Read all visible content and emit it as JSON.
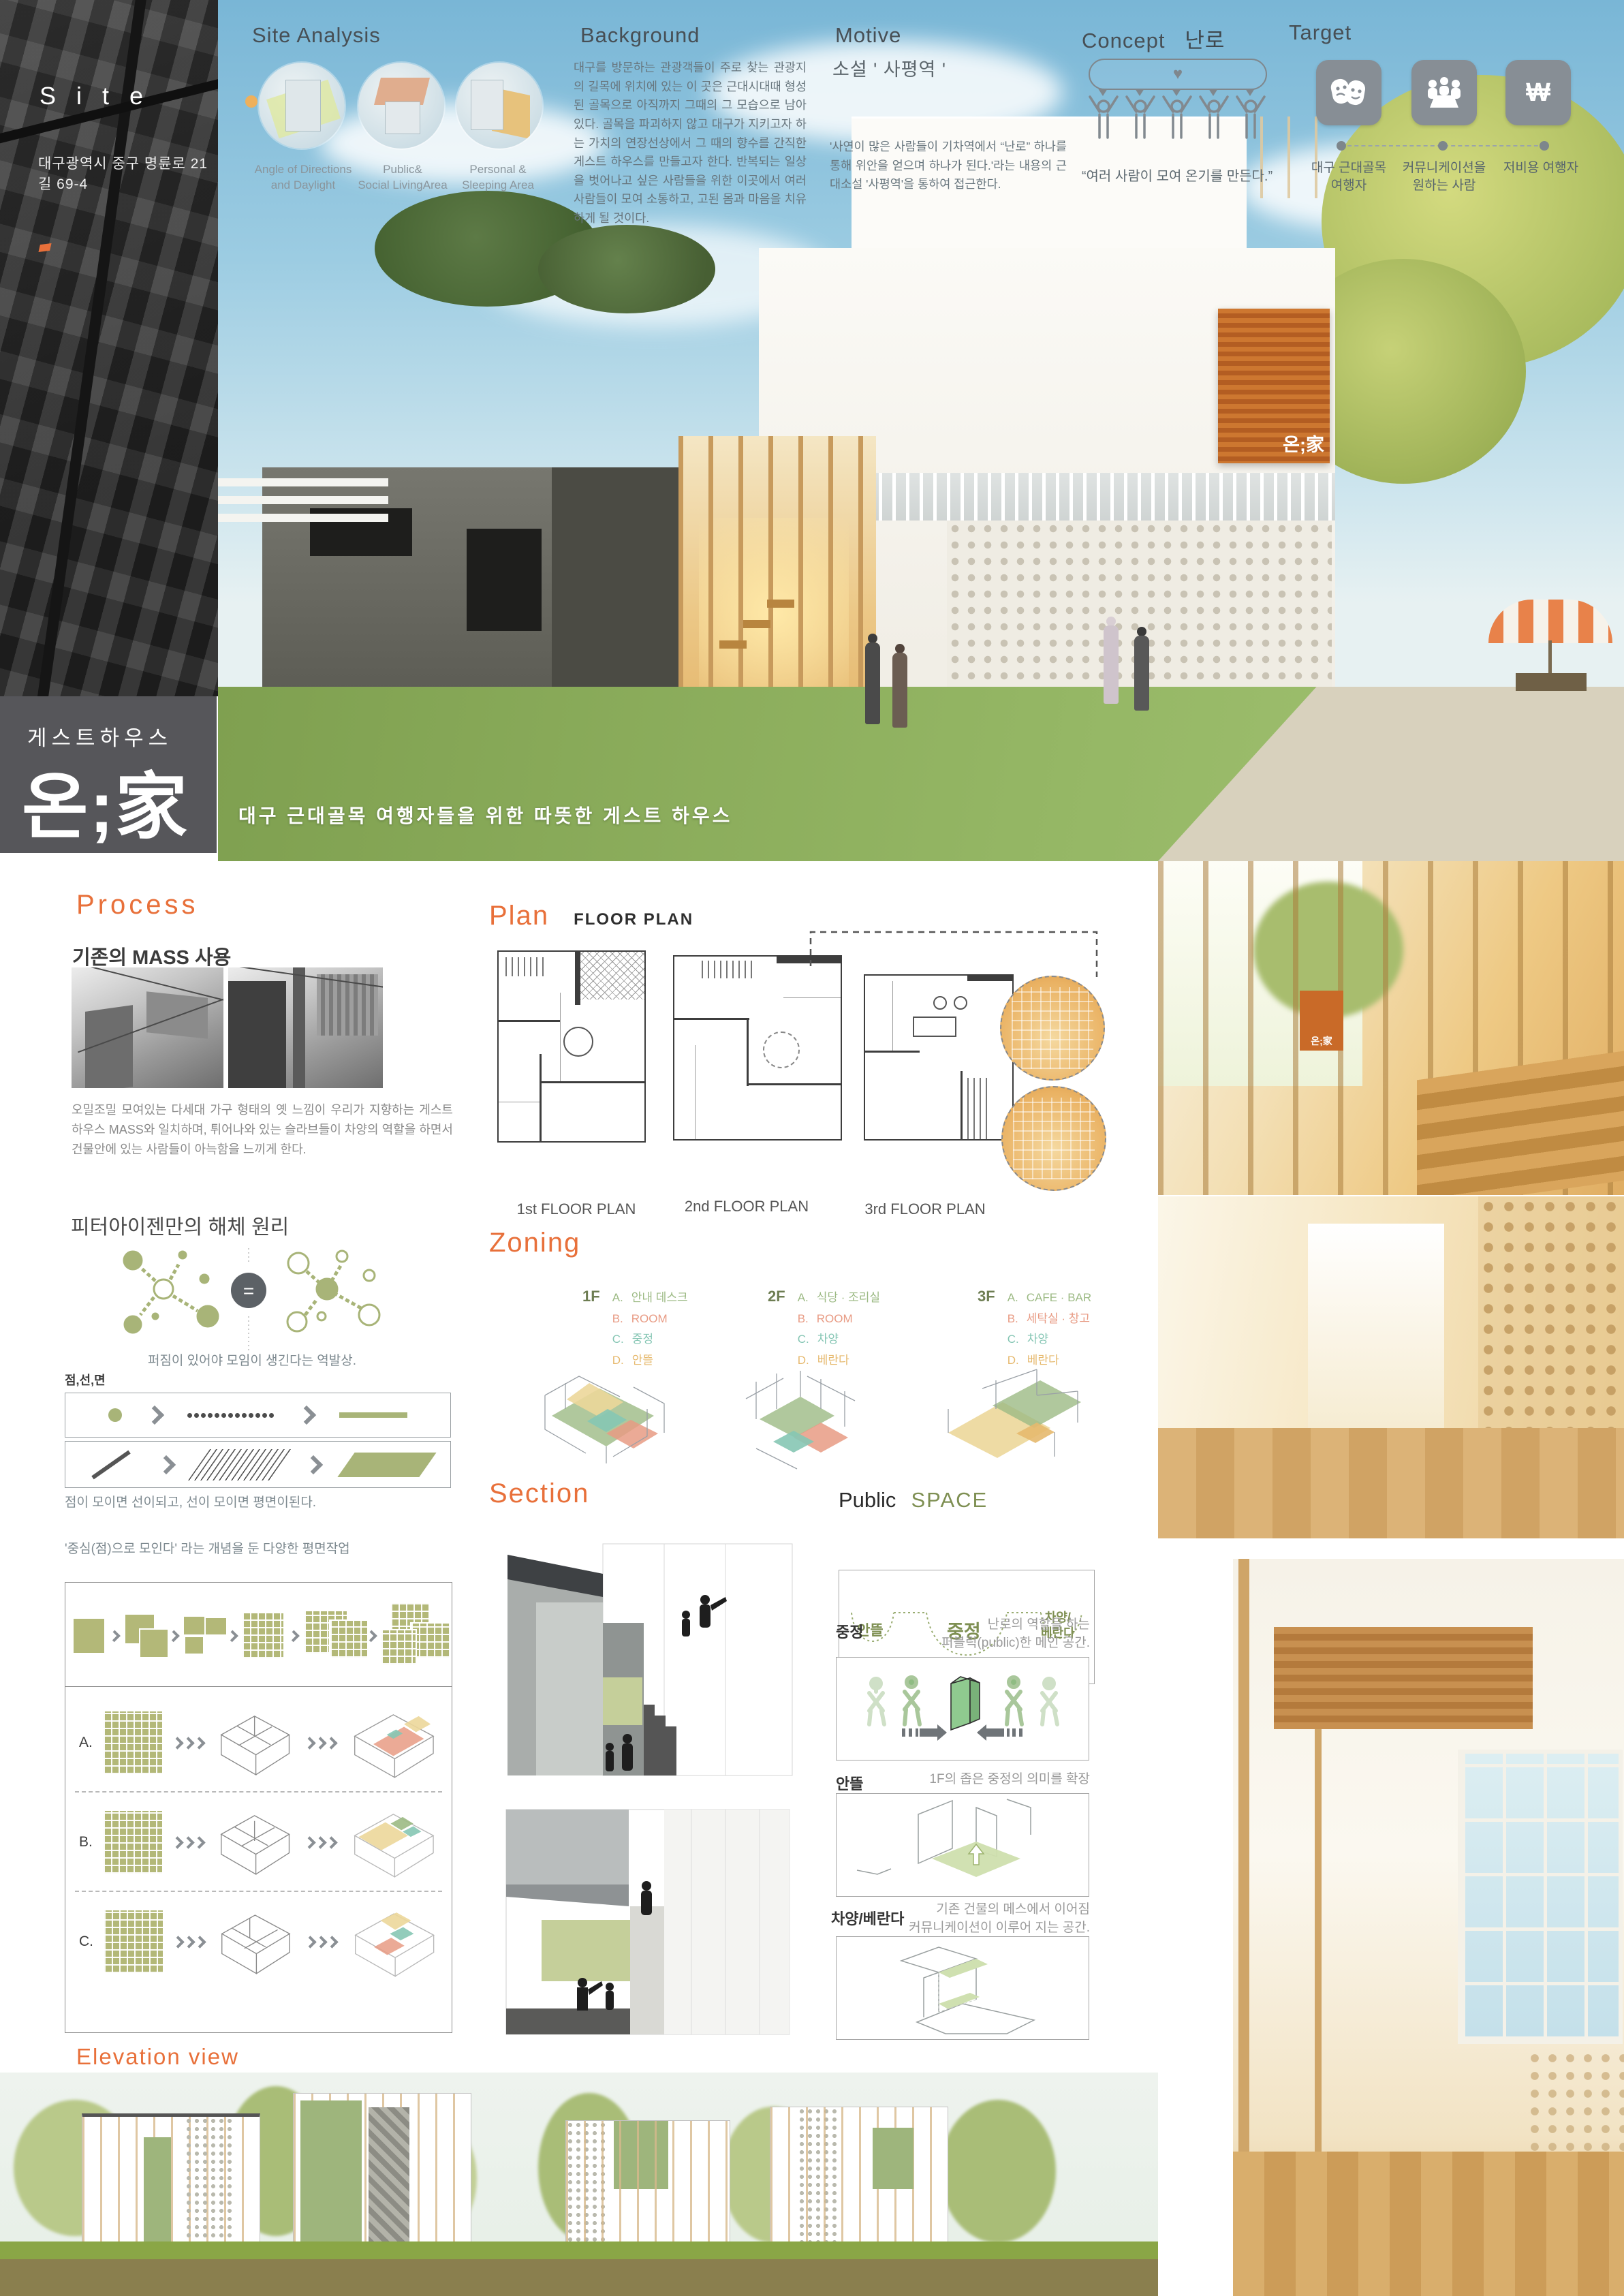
{
  "palette": {
    "accent_orange": "#e8703a",
    "olive_green": "#a8b478",
    "logo_gray": "#56565a",
    "legend_a_green": "#9cba84",
    "legend_b_salmon": "#e89b84",
    "legend_c_teal": "#86c6b4",
    "legend_d_orange": "#e6b96e"
  },
  "site": {
    "title": "S i t e",
    "address": "대구광역시 중구 명륜로 21길 69-4"
  },
  "site_analysis": {
    "title": "Site Analysis",
    "items": [
      {
        "label": "Angle of Directions\nand Daylight"
      },
      {
        "label": "Public&\nSocial LivingArea"
      },
      {
        "label": "Personal &\nSleeping Area"
      }
    ]
  },
  "background": {
    "title": "Background",
    "body": "대구를 방문하는 관광객들이 주로 찾는 관광지의 길목에 위치에 있는 이 곳은 근대시대때 형성된 골목으로 아직까지 그때의 그 모습으로 남아있다. 골목을 파괴하지 않고 대구가 지키고자 하는 가치의 연장선상에서 그 때의 향수를 간직한 게스트 하우스를 만들고자 한다. 반복되는 일상을 벗어나고 싶은 사람들을 위한  이곳에서 여러 사람들이 모여 소통하고, 고된 몸과 마음을 치유하게 될 것이다."
  },
  "motive": {
    "title": "Motive",
    "subtitle": "소설 ' 사평역 '",
    "body": "'사연이 많은 사람들이 기차역에서 “난로” 하나를 통해 위안을 얻으며 하나가 된다.'라는 내용의 근대소설 '사평역'을 통하여 접근한다."
  },
  "concept": {
    "title": "Concept",
    "keyword": "난로",
    "heart": "♥",
    "caption": "“여러 사람이 모여 온기를 만든다.”"
  },
  "target": {
    "title": "Target",
    "items": [
      {
        "icon": "theater-masks-icon",
        "label": "대구 근대골목\n여행자"
      },
      {
        "icon": "communication-table-icon",
        "label": "커뮤니케이션을\n원하는 사람"
      },
      {
        "icon": "won-currency-icon",
        "glyph": "₩",
        "label": "저비용 여행자"
      }
    ]
  },
  "brand": {
    "category": "게스트하우스",
    "logo": "온;家",
    "building_sign": "온;家",
    "tagline": "대구 근대골목 여행자들을 위한 따뜻한 게스트 하우스"
  },
  "process": {
    "title": "Process",
    "subtitle": "기존의 MASS 사용",
    "body": "오밀조밀 모여있는 다세대 가구 형태의 옛 느낌이 우리가 지향하는 게스트 하우스 MASS와 일치하며, 튀어나와 있는 슬라브들이 차양의 역할을 하면서 건물안에 있는 사람들이 아늑함을 느끼게 한다."
  },
  "eisenman": {
    "title": "피터아이젠만의 해체 원리",
    "equals": "=",
    "caption_nodes": "퍼짐이 있어야 모임이 생긴다는 역발상.",
    "pointlineplane_label": "점,선,면",
    "caption_pointline": "점이 모이면 선이되고, 선이 모이면 평면이된다.",
    "caption_center": "'중심(점)으로 모인다' 라는 개념을 둔 다양한 평면작업",
    "rows": [
      {
        "key": "A."
      },
      {
        "key": "B."
      },
      {
        "key": "C."
      }
    ]
  },
  "plan": {
    "title": "Plan",
    "subtitle": "FLOOR PLAN",
    "labels": [
      "1st FLOOR PLAN",
      "2nd FLOOR PLAN",
      "3rd FLOOR PLAN"
    ]
  },
  "zoning": {
    "title": "Zoning",
    "floors": [
      {
        "name": "1F",
        "legend": [
          {
            "key": "A.",
            "label": "안내 데스크"
          },
          {
            "key": "B.",
            "label": "ROOM"
          },
          {
            "key": "C.",
            "label": "중정"
          },
          {
            "key": "D.",
            "label": "안뜰"
          }
        ]
      },
      {
        "name": "2F",
        "legend": [
          {
            "key": "A.",
            "label": "식당 · 조리실"
          },
          {
            "key": "B.",
            "label": "ROOM"
          },
          {
            "key": "C.",
            "label": "차양"
          },
          {
            "key": "D.",
            "label": "베란다"
          }
        ]
      },
      {
        "name": "3F",
        "legend": [
          {
            "key": "A.",
            "label": "CAFE · BAR"
          },
          {
            "key": "B.",
            "label": "세탁실 · 창고"
          },
          {
            "key": "C.",
            "label": "차양"
          },
          {
            "key": "D.",
            "label": "베란다"
          }
        ]
      }
    ]
  },
  "section": {
    "title": "Section"
  },
  "public_space": {
    "title_left": "Public",
    "title_right": "SPACE",
    "bar_labels": [
      "안뜰",
      "중정",
      "차양/\n베란다"
    ],
    "blocks": [
      {
        "label": "중정",
        "desc": "난로의 역할을 하는\n퍼블릭(public)한 메인 공간."
      },
      {
        "label": "안뜰",
        "desc": "1F의 좁은 중정의 의미를 확장"
      },
      {
        "label": "차양/베란다",
        "desc": "기존 건물의 메스에서 이어짐\n커뮤니케이션이 이루어 지는 공간."
      }
    ]
  },
  "elevation": {
    "title": "Elevation view"
  }
}
